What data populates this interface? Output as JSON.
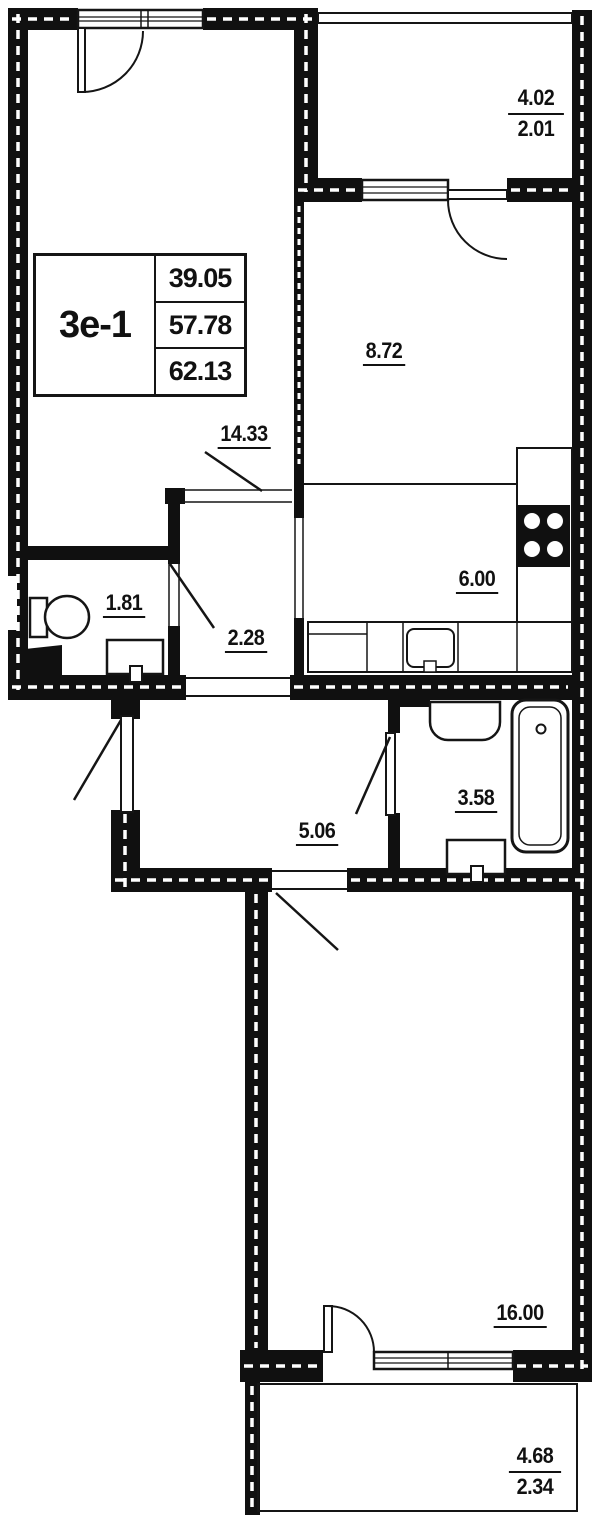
{
  "unit_card": {
    "unit": "3е-1",
    "living_area": "39.05",
    "apartment_area": "57.78",
    "total_area": "62.13"
  },
  "rooms": {
    "living": "14.33",
    "room": "8.72",
    "kitchen": "6.00",
    "wc": "1.81",
    "hall": "2.28",
    "corridor": "5.06",
    "bathroom": "3.58",
    "bedroom": "16.00"
  },
  "balconies": {
    "top": {
      "full": "4.02",
      "reduced": "2.01"
    },
    "bottom": {
      "full": "4.68",
      "reduced": "2.34"
    }
  },
  "colors": {
    "wall": "#101010",
    "line": "#151515",
    "bg": "#ffffff"
  }
}
